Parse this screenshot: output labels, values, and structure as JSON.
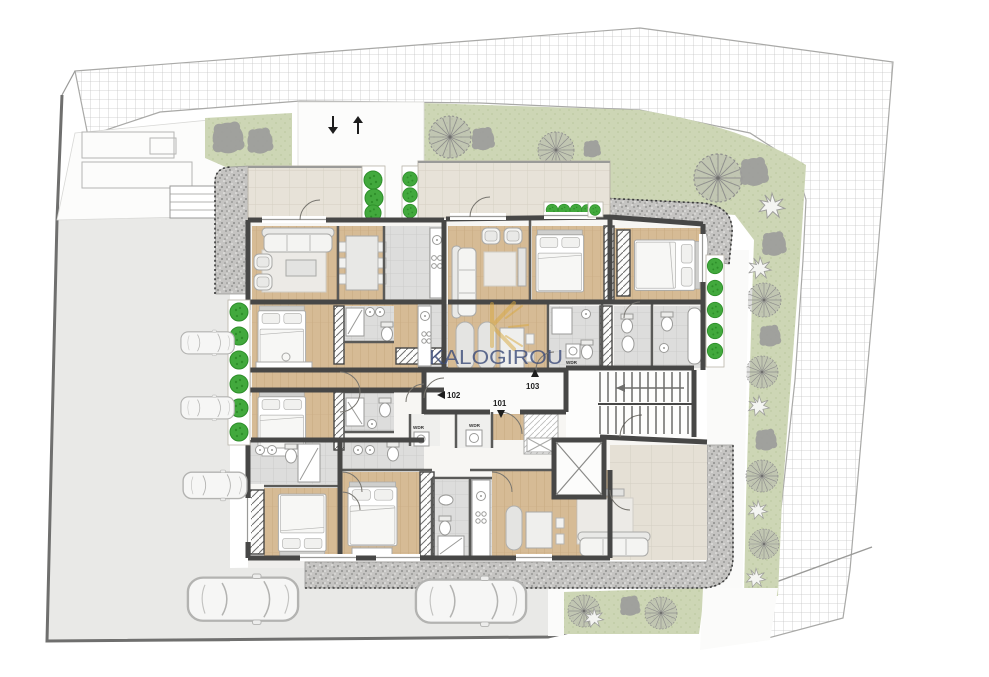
{
  "watermark": {
    "monogram": "K",
    "brand": "KALOGIROU",
    "brand_color": "#3c4c7a",
    "monogram_color": "#d9a93e"
  },
  "units": {
    "u101": "101",
    "u102": "102",
    "u103": "103"
  },
  "closets": {
    "wdr1": "WDR",
    "wdr2": "WDR",
    "wdr3": "WDR"
  },
  "palette": {
    "wall": "#474746",
    "wood_floor": "#d6bb95",
    "tile_floor": "#dddddc",
    "balcony_tile": "#e7e2d8",
    "terrace_tile": "#e5e0d5",
    "grass": "#cdd6b5",
    "hedge_green": "#42a93d",
    "gravel": "#c5c4c2",
    "driveway": "#e9e9e7",
    "hatch_line": "#c6c6c6",
    "boundary": "#6f6f6e",
    "tree_gray": "#9d9d9b"
  },
  "icons": {
    "tree-radial": "spoked-gray-circle",
    "tree-blob": "solid-gray-canopy",
    "tree-flower": "white-star-canopy",
    "bush": "green-shrub-circle",
    "car": "top-view-car",
    "stairs": "tread-lines-with-arrow",
    "elevator": "crossed-box",
    "entry-arrow": "small-black-arrow"
  }
}
